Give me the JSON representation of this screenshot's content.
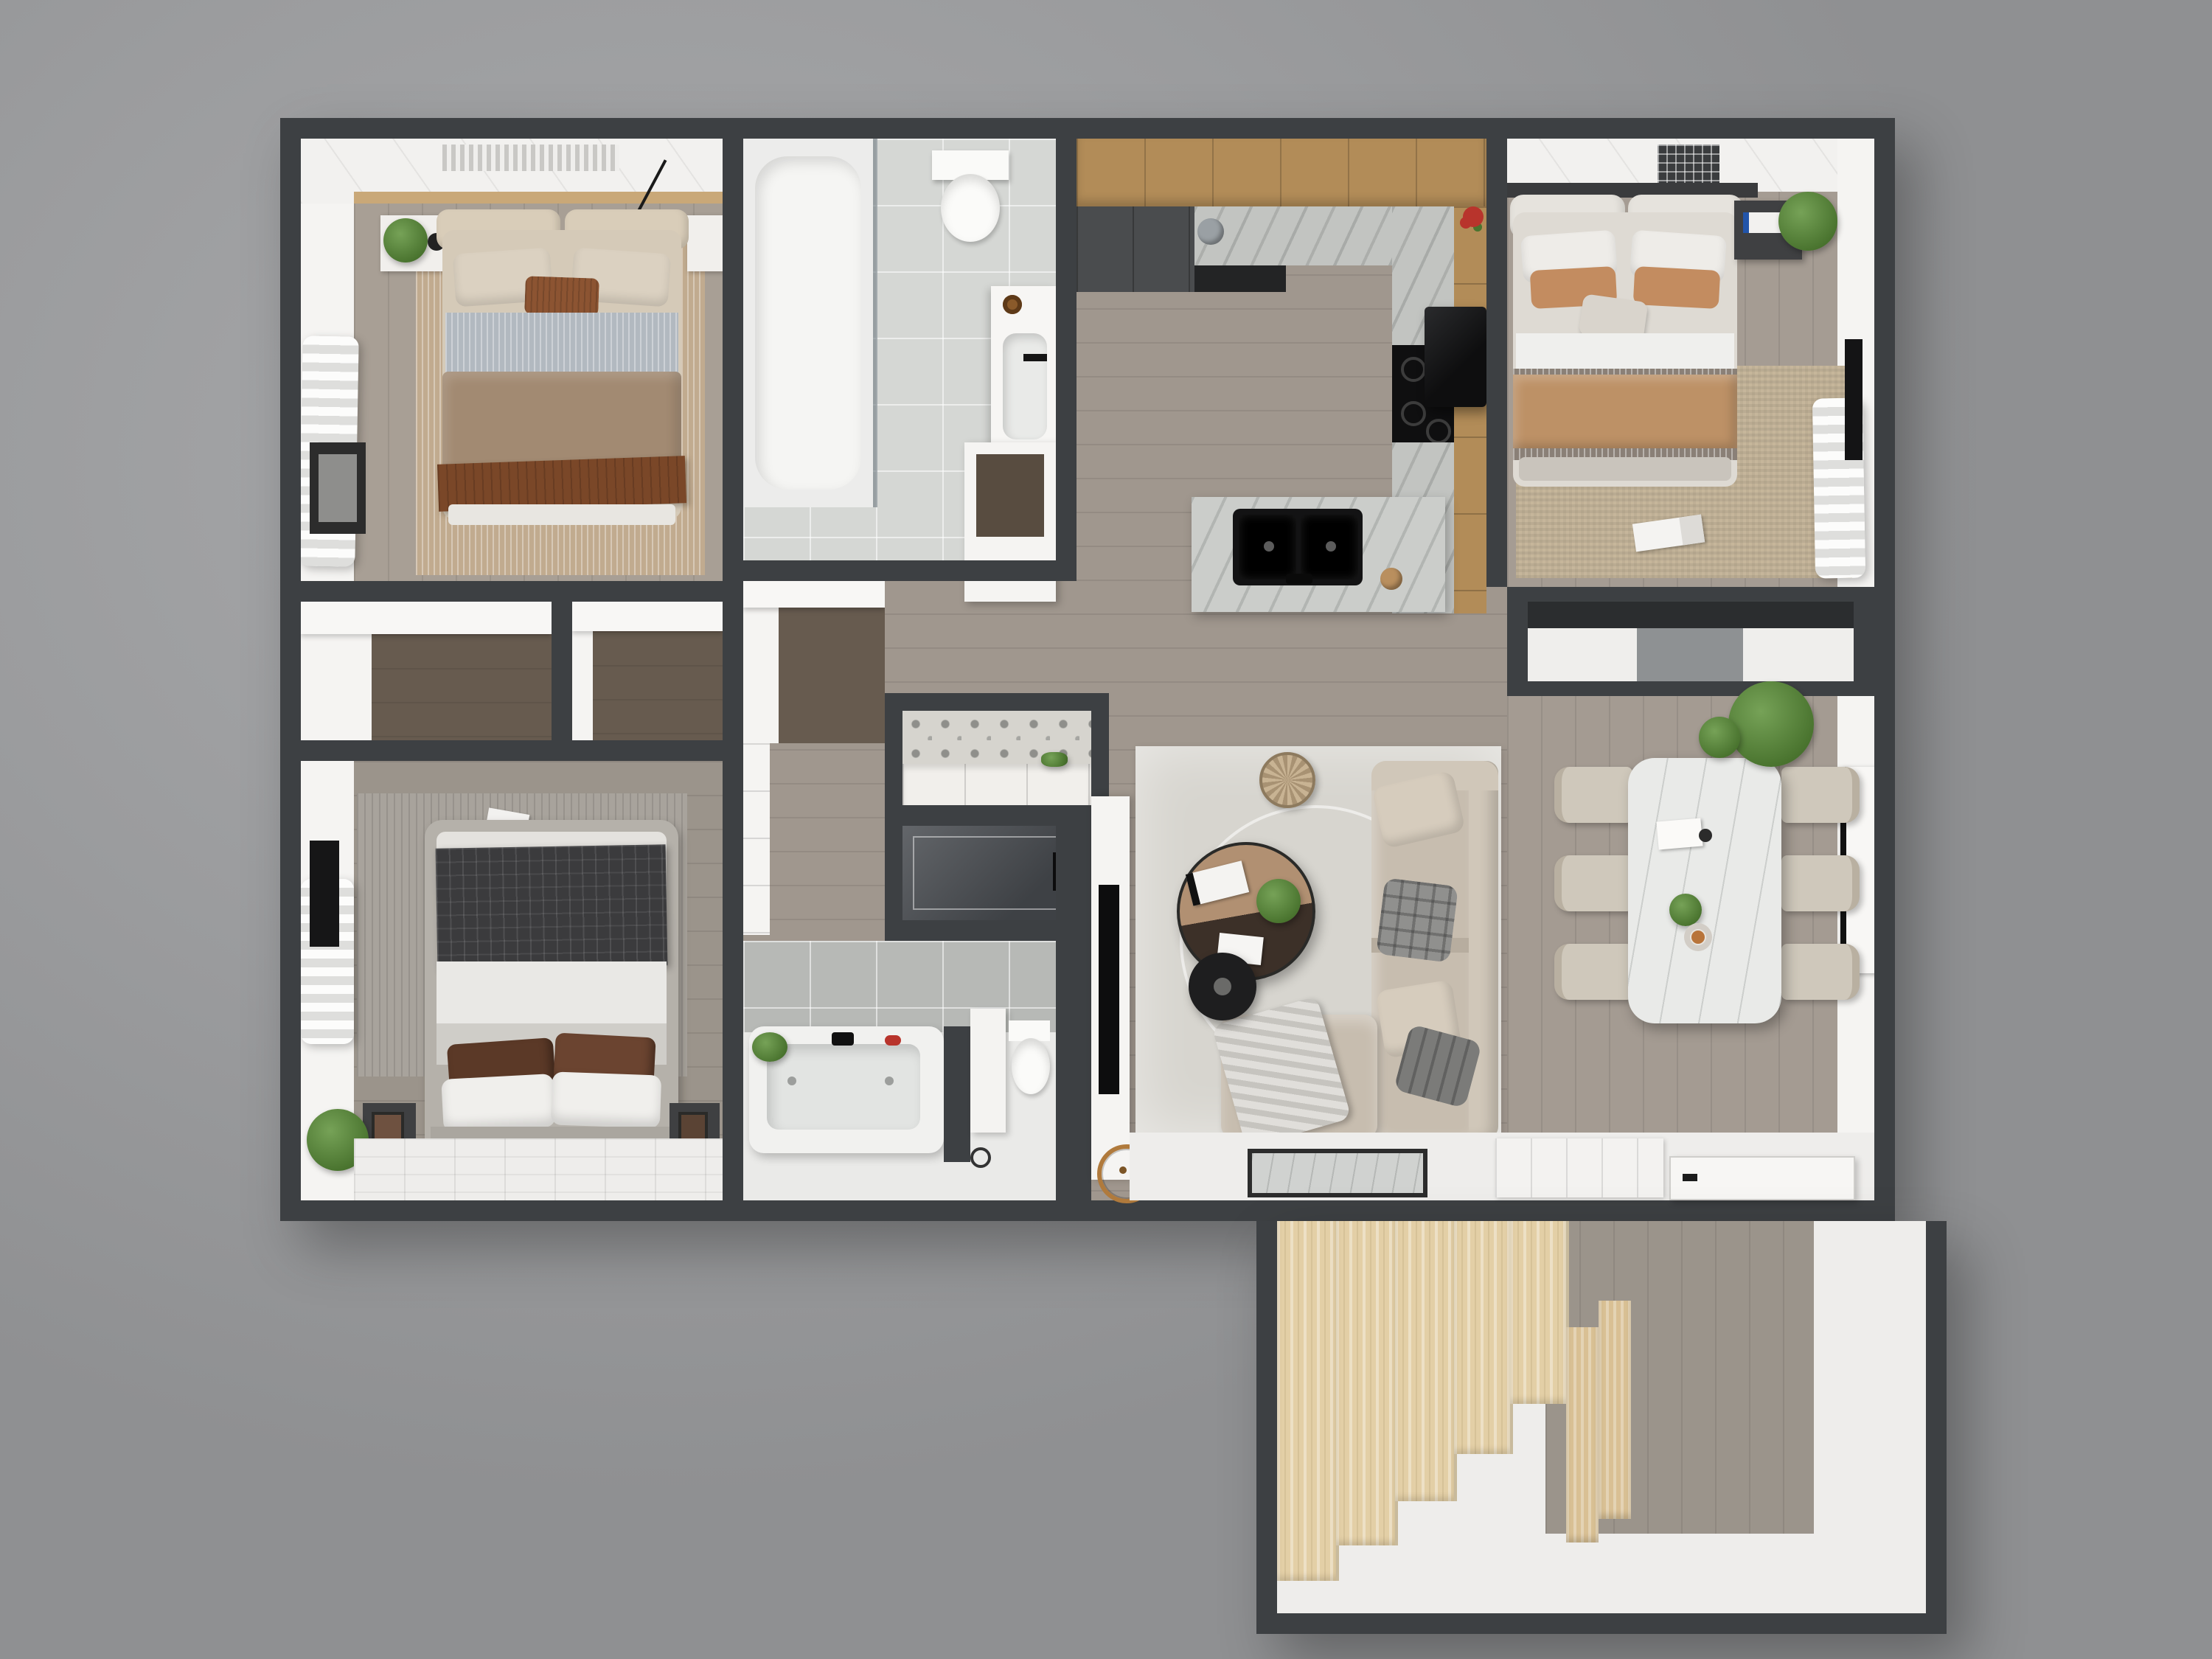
{
  "scene": {
    "kind": "3d-rendered floor plan, top-down view",
    "sections": [
      "main floor",
      "stairwell annex (bottom right)"
    ],
    "visible_text": "none"
  },
  "palette": {
    "bg": "#9b9c9e",
    "bgLight": "#a8a9ab",
    "bgDark": "#8f9092",
    "wall": "#3d4043",
    "wallDeep": "#2b2d2f",
    "whiteWall": "#f5f4f2",
    "whiteFloor": "#eeedeb",
    "ceiling": "#f2f1ef",
    "woodMain": "#a0978e",
    "woodBed1": "#a89f95",
    "woodBed2": "#a59c93",
    "woodBed3": "#9b948b",
    "woodDining": "#a49b92",
    "woodDark": "#675b4f",
    "tileBath": "#d5d7d4",
    "tileBath2Wall": "#b7b9b6",
    "bath2Floor": "#eaeae8",
    "marbleCounter": "#c2c4c1",
    "marbleIsland": "#cbcdca",
    "marbleTable": "#e9eae8",
    "cabinetWood": "#b28c58",
    "cabinetDark": "#4a4c4e",
    "stairsWood": "#e3cfa6",
    "stairsWoodDark": "#d9c094",
    "rugBed1": "#c1ab8f",
    "rugBed2": "#c6b69b",
    "rugBed3": "#a8a39c",
    "rugLiving": "#d7d5cf",
    "sofa": "#c7bdaf",
    "sofaBack": "#d0c7b9",
    "chair": "#cfc8bb",
    "coffeeTop": "#b19072",
    "coffeeDark": "#3c3028",
    "duvetTaupe": "#a28a72",
    "sheetStripe": "#b2b9c0",
    "throwBrown": "#7a4728",
    "pillowBeige": "#dbd1c1",
    "pillowAccent": "#8c5432",
    "blanketTan": "#bd9166",
    "plaidDark": "#3b3b3d",
    "pillowVelvet": "#5b3927",
    "bedGray": "#b5b1aa",
    "black": "#1d1d1e",
    "plantGreen": "#5c8742",
    "accentRed": "#b8342c",
    "copper": "#b07a3c"
  },
  "rooms": [
    {
      "id": "bedroom-1",
      "label": "bedroom top-left",
      "furniture": [
        "double bed",
        "headboard cushions",
        "beige pillows",
        "brown accent pillow",
        "gray striped sheet",
        "taupe duvet",
        "brown fringed throw",
        "nightstands",
        "potted plant",
        "tan rug",
        "sheer curtain",
        "framed artwork",
        "pendant lamps"
      ]
    },
    {
      "id": "bathroom-1",
      "label": "bathroom top-middle",
      "furniture": [
        "shower / tub enclosure",
        "toilet",
        "vanity with sink"
      ]
    },
    {
      "id": "kitchen",
      "label": "kitchen",
      "furniture": [
        "upper wood cabinets",
        "dark base cabinets",
        "granite U-counter",
        "black cooktop",
        "black range hood",
        "island with double black sink",
        "red flowers",
        "kettle"
      ]
    },
    {
      "id": "bedroom-2",
      "label": "bedroom top-right",
      "furniture": [
        "double bed",
        "white pillows",
        "tan pillows",
        "tan blanket",
        "dark nightstand",
        "hanging plant",
        "woven rug",
        "magazine",
        "sheer curtain",
        "wall TV",
        "ceiling vent"
      ]
    },
    {
      "id": "closet-a",
      "label": "walk-in closet left"
    },
    {
      "id": "closet-b",
      "label": "walk-in closet center-left"
    },
    {
      "id": "closet-c",
      "label": "hall closet"
    },
    {
      "id": "pantry",
      "label": "hall cabinet"
    },
    {
      "id": "laundry",
      "label": "laundry nook with patterned tile and white cabinet"
    },
    {
      "id": "shower-room",
      "label": "dark walk-in shower"
    },
    {
      "id": "bathroom-2",
      "label": "bathroom bottom-middle",
      "furniture": [
        "jetted bathtub",
        "toilet",
        "partition bench",
        "plant"
      ]
    },
    {
      "id": "bedroom-3",
      "label": "bedroom bottom-left",
      "furniture": [
        "gray platform bed",
        "dark plaid blanket",
        "brown velvet pillows",
        "white pillows",
        "ribbed gray rug",
        "nightstands",
        "plant",
        "sheer curtain",
        "wall TV",
        "magazine"
      ]
    },
    {
      "id": "living-room",
      "label": "living room",
      "furniture": [
        "L-shaped sectional sofa",
        "throw pillows",
        "plaid pillow",
        "throw blanket",
        "round two-tone coffee table",
        "books",
        "black disc tray",
        "woven basket",
        "area rug",
        "TV wall panel",
        "copper wheel decor"
      ]
    },
    {
      "id": "dining-room",
      "label": "dining room",
      "furniture": [
        "marble dining table",
        "six beige chairs",
        "large plant",
        "wall art panel",
        "table decor"
      ]
    },
    {
      "id": "entry",
      "label": "entry strip",
      "furniture": [
        "marble doormat",
        "open door leaf",
        "paneled door"
      ]
    },
    {
      "id": "stairwell",
      "label": "stair annex",
      "furniture": [
        "light wood staircase",
        "gray wood landing",
        "white floor"
      ]
    }
  ]
}
